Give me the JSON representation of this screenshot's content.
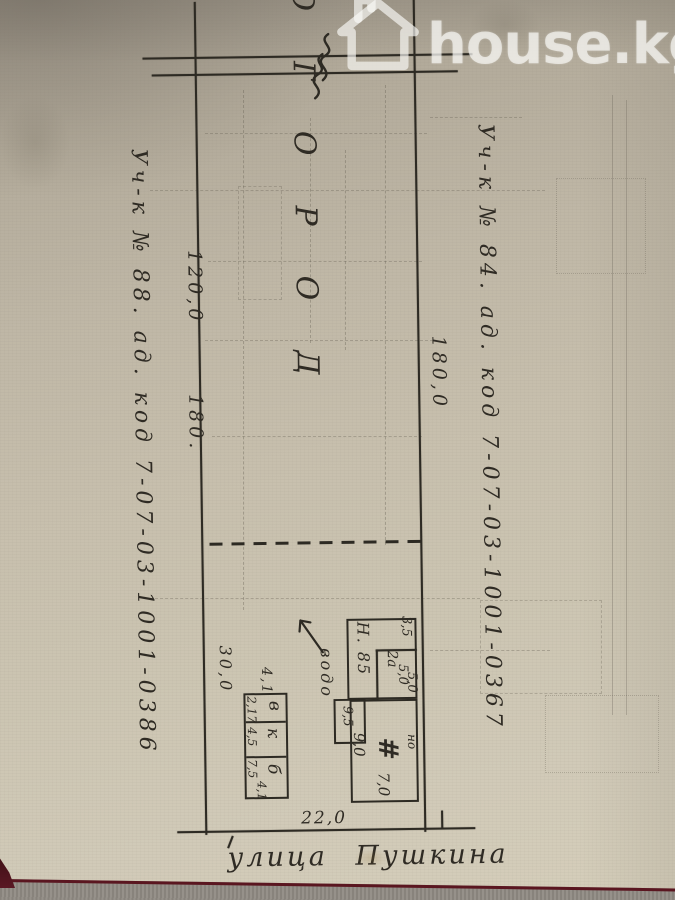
{
  "watermark": {
    "brand": "house.kg",
    "icon": "house-logo"
  },
  "plan": {
    "street": "улица Пушкина",
    "garden": "ОГОРОД",
    "notes": {
      "left_parcel": "Уч-к № 88. ад. код 7-07-03-1001-0386",
      "right_parcel": "Уч-к № 84. ад. код 7-07-03-1001-0367",
      "utility": "водо"
    },
    "dimensions": {
      "left_upper": "120,0",
      "left_middle": "180.",
      "right_middle": "180,0",
      "yard_depth": "30,0",
      "street_frontage": "22,0"
    },
    "outbuildings": {
      "top_width": "4,1",
      "bottom_width": "4,1",
      "rooms": [
        {
          "label": "в",
          "size": "2,17"
        },
        {
          "label": "к",
          "size": "4,5"
        },
        {
          "label": "б",
          "size": "7,5"
        }
      ]
    },
    "house_block": {
      "kitchen_label": "Н. 85",
      "kitchen_size": "3,5",
      "kitchen_room_label": "2а",
      "kitchen_room_size": "5,0",
      "kitchen_room_size2": "5,0",
      "porch_size": "9,5",
      "house_width": "9,0",
      "house_hatch": "#",
      "house_note": "но",
      "house_depth": "7,0"
    }
  }
}
